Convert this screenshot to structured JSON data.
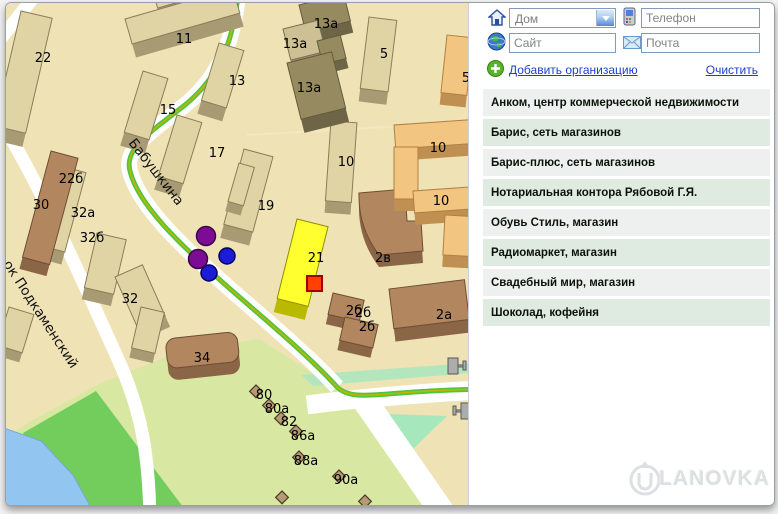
{
  "panel": {
    "fields": {
      "house_value": "Дом",
      "phone_placeholder": "Телефон",
      "site_placeholder": "Сайт",
      "mail_placeholder": "Почта"
    },
    "links": {
      "add": "Добавить организацию",
      "clear": "Очистить"
    },
    "organizations": [
      "Анком, центр коммерческой недвижимости",
      "Барис, сеть магазинов",
      "Барис-плюс, сеть магазинов",
      "Нотариальная контора Рябовой Г.Я.",
      "Обувь Стиль, магазин",
      "Радиомаркет, магазин",
      "Свадебный мир, магазин",
      "Шоколад, кофейня"
    ]
  },
  "map": {
    "street_labels": [
      {
        "text": "Бабушкина"
      },
      {
        "text": "ок Подкаменский"
      }
    ],
    "building_labels": [
      "22",
      "11",
      "13а",
      "13а",
      "13а",
      "13",
      "15",
      "5",
      "17",
      "19",
      "5",
      "10",
      "10",
      "10",
      "21",
      "2в",
      "2а",
      "2б",
      "2б",
      "2б",
      "22б",
      "30",
      "32а",
      "32б",
      "32",
      "34",
      "80",
      "80а",
      "82",
      "86а",
      "88а",
      "90а"
    ],
    "colors": {
      "land": "#EFE3B6",
      "park": "#D8E7A2",
      "lawn": "#72CD5D",
      "water": "#92C5F0",
      "highlight_building": "#FFFF30",
      "marker_red": "#FF4000",
      "marker_purple": "#7D0C94",
      "marker_blue": "#1C1CD8",
      "tram_line_green": "#4FC53E",
      "tram_line_yellow": "#C3B400"
    }
  },
  "watermark": {
    "logo": "U",
    "text": "LANOVKA"
  }
}
